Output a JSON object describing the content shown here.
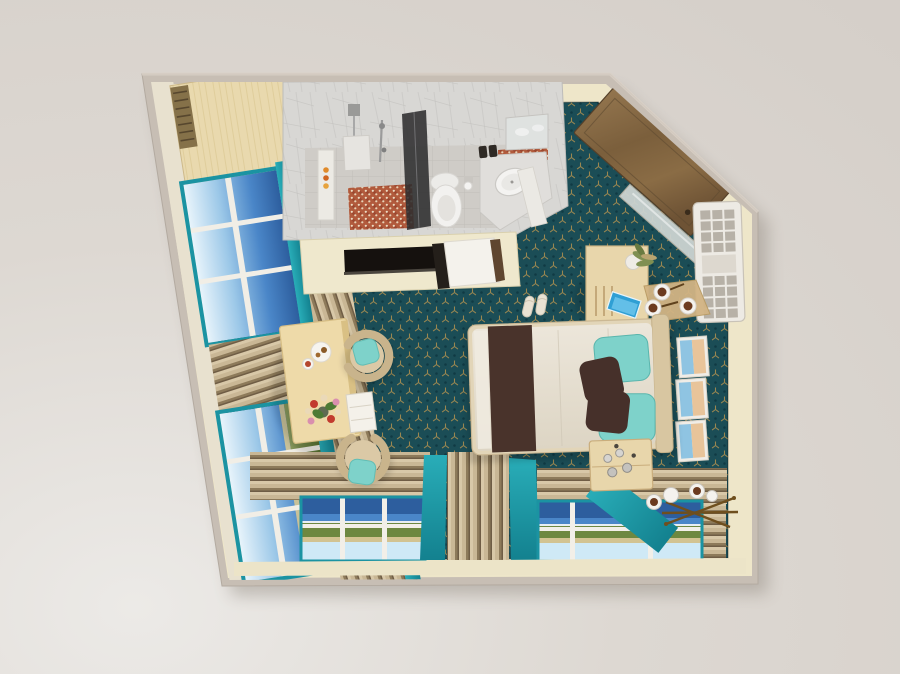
{
  "scene": {
    "type": "3d-floor-plan-render",
    "view": "top-down",
    "room": "hotel-suite-with-bathroom"
  },
  "features": [
    "bathroom-with-shower-toilet-sink",
    "terracotta-mosaic-shower-floor",
    "tv-console",
    "bathroom-door",
    "wardrobe-closet",
    "entry-door-wood",
    "wall-mirror",
    "air-conditioner-shelf-unit",
    "dresser-with-plant",
    "coffee-tray-three-cups",
    "blue-magazines",
    "three-beach-art-frames",
    "double-bed-cream-duvet",
    "brown-bed-runner",
    "teal-pillows",
    "brown-accent-pillows",
    "slippers",
    "nightstand-with-bottles",
    "brass-luggage-rack",
    "tea-cups",
    "desk-with-breakfast",
    "flower-bouquet",
    "two-shell-armchairs-teal-cushions",
    "teal-framed-windows-sea-view",
    "tan-drapes",
    "teal-curtains",
    "dark-teal-patterned-carpet"
  ],
  "colors": {
    "background": "#d9d3cd",
    "wall_outer": "#c7beb4",
    "wall_inner": "#eee6c9",
    "carpet": "#1b4d56",
    "carpet_motif": "#a78c50",
    "curtain_teal": "#1ba0ad",
    "window_frame_teal": "#1b93a2",
    "drape_light": "#c9b795",
    "drape_dark": "#6f5d45",
    "sea": "#2d5e9e",
    "sky": "#dff0fa",
    "grass": "#6d8840",
    "sand": "#d2c391",
    "bed_duvet": "#e9e3d6",
    "bed_runner": "#49332b",
    "pillow_teal": "#7ed2ca",
    "pillow_brown": "#46302a",
    "headboard": "#d8c6a1",
    "desk_wood": "#eedaa9",
    "furniture_wood": "#e8d6ab",
    "door_wood": "#82653f",
    "closet_wood": "#e9d9ae",
    "bath_marble": "#d8d7d4",
    "bath_tile": "#cfccc7",
    "mosaic": "#b15a3c",
    "fixture_white": "#f2f1ef",
    "tv_black": "#15110e",
    "ac_white": "#edeae4",
    "art_blue": "#8fc4e2",
    "art_peach": "#e8c49a",
    "brass": "#6f4f1e",
    "coffee": "#6b3a1f",
    "slipper": "#e9e2d3",
    "plant_green": "#7f8f52",
    "flower_red": "#c23b2e",
    "flower_pink": "#d98fae",
    "bottle_orange": "#d98127"
  }
}
